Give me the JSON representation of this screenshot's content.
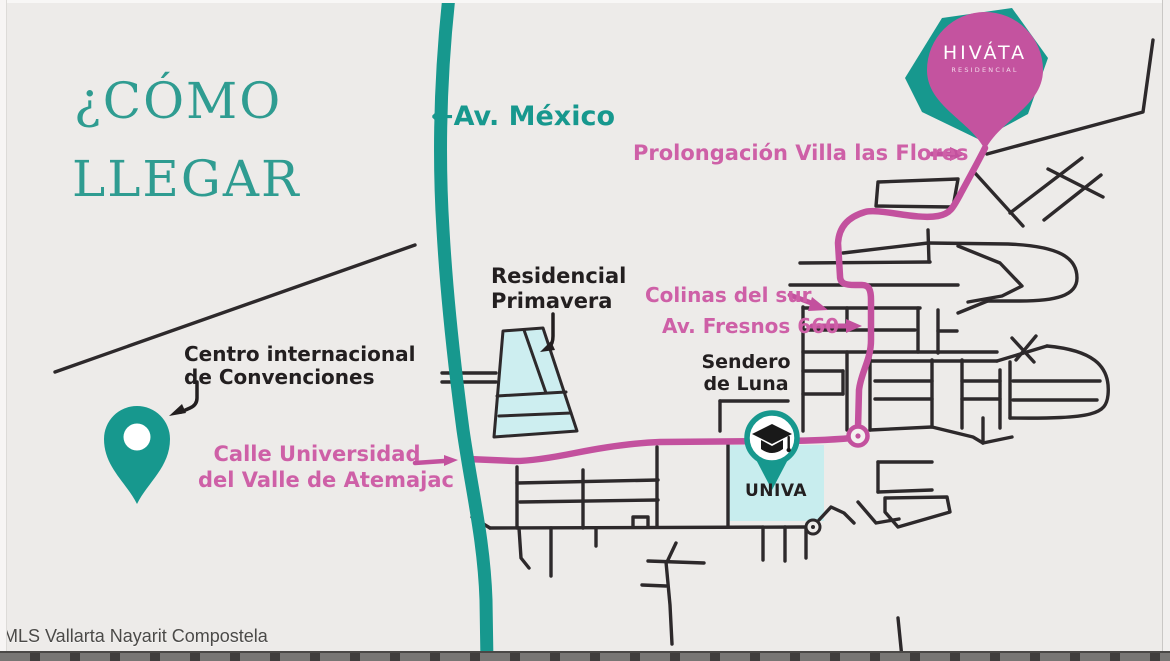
{
  "title": {
    "line1": "¿CÓMO",
    "line2": "LLEGAR"
  },
  "roads": {
    "av_mexico_arrow": "←",
    "av_mexico": "Av. México",
    "prolongacion_villa_las_flores": "Prolongación Villa las Flores",
    "colinas_del_sur": "Colinas del sur",
    "av_fresnos": "Av. Fresnos 660",
    "calle_universidad_line1": "Calle Universidad",
    "calle_universidad_line2": "del Valle de Atemajac"
  },
  "places": {
    "residencial_primavera_line1": "Residencial",
    "residencial_primavera_line2": "Primavera",
    "centro_convenciones_line1": "Centro internacional",
    "centro_convenciones_line2": "de Convenciones",
    "sendero_de_luna_line1": "Sendero",
    "sendero_de_luna_line2": "de Luna",
    "univa": "UNIVA",
    "hivata_name": "HIVÁTA",
    "hivata_sub": "RESIDENCIAL"
  },
  "watermark": "MLS Vallarta Nayarit Compostela",
  "icons": {
    "map_pin_teal": "location-pin-icon",
    "map_pin_hivata": "location-pin-icon",
    "graduation_cap": "graduation-cap-icon",
    "roundabout": "roundabout-icon"
  },
  "colors": {
    "teal": "#17988e",
    "pink_route": "#c3519e",
    "pink_label": "#ce60a7",
    "road_black": "#2d292b",
    "background": "#edebe9",
    "light_cyan": "#cdeef0",
    "title_teal": "#2f9c91"
  }
}
